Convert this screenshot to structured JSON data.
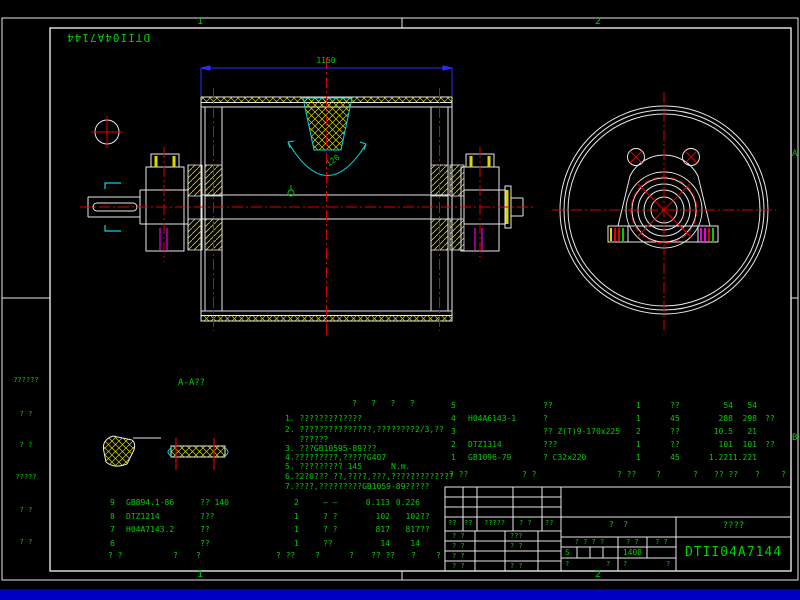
{
  "colors": {
    "background": "#000000",
    "line_white": "#E8E8E8",
    "text_green": "#00CE00",
    "dimension_blue": "#2B2BFF",
    "centerline_red": "#DE0000",
    "hatch_yellow": "#D8D800",
    "detail_cyan": "#00DADA",
    "accent_magenta": "#E800E8",
    "bottom_strip_blue": "#0000C4"
  },
  "zones": {
    "top": [
      "1",
      "2"
    ],
    "bottom": [
      "1",
      "2"
    ],
    "right": [
      "A",
      "B"
    ]
  },
  "sheet": {
    "doc_number_mirrored": "DTII04A7144"
  },
  "front_view": {
    "dim_length": "1150",
    "wrap_angle": "120"
  },
  "section_label": "A-A??",
  "notes": {
    "heading": "?   ?   ?   ?",
    "lines": [
      "1. ?????????????",
      "2. ???????????????,????????2/3,??",
      "   ??????",
      "3. ???GB10595-89???",
      "4.?????????,?????G407",
      "5. ????????? 145      N.m.",
      "6.?2?0??? ??,????,???,?????????????",
      "7.????,?????????GB1059-89?????"
    ]
  },
  "parts_right": {
    "headers": [
      "? ??",
      "? ?",
      "? ??",
      "?",
      "?",
      "?? ??",
      "?",
      "?"
    ],
    "rows": [
      {
        "seq": "5",
        "code": "",
        "name": "??",
        "qty": "1",
        "material": "??",
        "unit": "54",
        "total": "54",
        "remark": ""
      },
      {
        "seq": "4",
        "code": "H04A6143-1",
        "name": "?",
        "qty": "1",
        "material": "45",
        "unit": "288",
        "total": "298",
        "remark": "??"
      },
      {
        "seq": "3",
        "code": "",
        "name": "?? Z(T)9-170x225",
        "qty": "2",
        "material": "??",
        "unit": "10.5",
        "total": "21",
        "remark": ""
      },
      {
        "seq": "2",
        "code": "DTZ1314",
        "name": "???",
        "qty": "1",
        "material": "??",
        "unit": "101",
        "total": "101",
        "remark": "??"
      },
      {
        "seq": "1",
        "code": "GB1096-79",
        "name": "? C32x220",
        "qty": "1",
        "material": "45",
        "unit": "1.221",
        "total": "1.221",
        "remark": ""
      }
    ]
  },
  "parts_left": {
    "headers": [
      "? ?",
      "?",
      "?",
      "? ??",
      "?",
      "?",
      "?? ??",
      "?",
      "?"
    ],
    "rows": [
      {
        "seq": "9",
        "code": "GB894.1-86",
        "name": "?? 140",
        "qty": "2",
        "material": "— —",
        "unit": "0.113",
        "total": "0.226",
        "remark": ""
      },
      {
        "seq": "8",
        "code": "DTZ1214",
        "name": "???",
        "qty": "1",
        "material": "? ?",
        "unit": "102",
        "total": "102",
        "remark": "??"
      },
      {
        "seq": "7",
        "code": "H04A7143.2",
        "name": "??",
        "qty": "1",
        "material": "? ?",
        "unit": "817",
        "total": "817",
        "remark": "??"
      },
      {
        "seq": "6",
        "code": "",
        "name": "??",
        "qty": "1",
        "material": "??",
        "unit": "14",
        "total": "14",
        "remark": ""
      }
    ]
  },
  "title_block": {
    "sign_row": [
      "??",
      "??",
      "?????",
      "? ?",
      "??"
    ],
    "left_rows": [
      [
        "? ?",
        "???"
      ],
      [
        "? ?",
        "? ?"
      ],
      [
        "? ?",
        ""
      ],
      [
        "? ?",
        "? ?"
      ]
    ],
    "stage": "?  ?",
    "approval_cells": [
      "? ? ? ?",
      "? ?",
      "? ?"
    ],
    "sheet_s": "S",
    "sheet_no": "1408",
    "bottom_row": [
      "?",
      "?",
      "?",
      "?"
    ],
    "company": "????",
    "drawing_number": "DTII04A7144"
  },
  "margin_left": {
    "items": [
      "??????",
      "? ?",
      "? ?",
      "?????",
      "? ?",
      "? ?"
    ]
  }
}
